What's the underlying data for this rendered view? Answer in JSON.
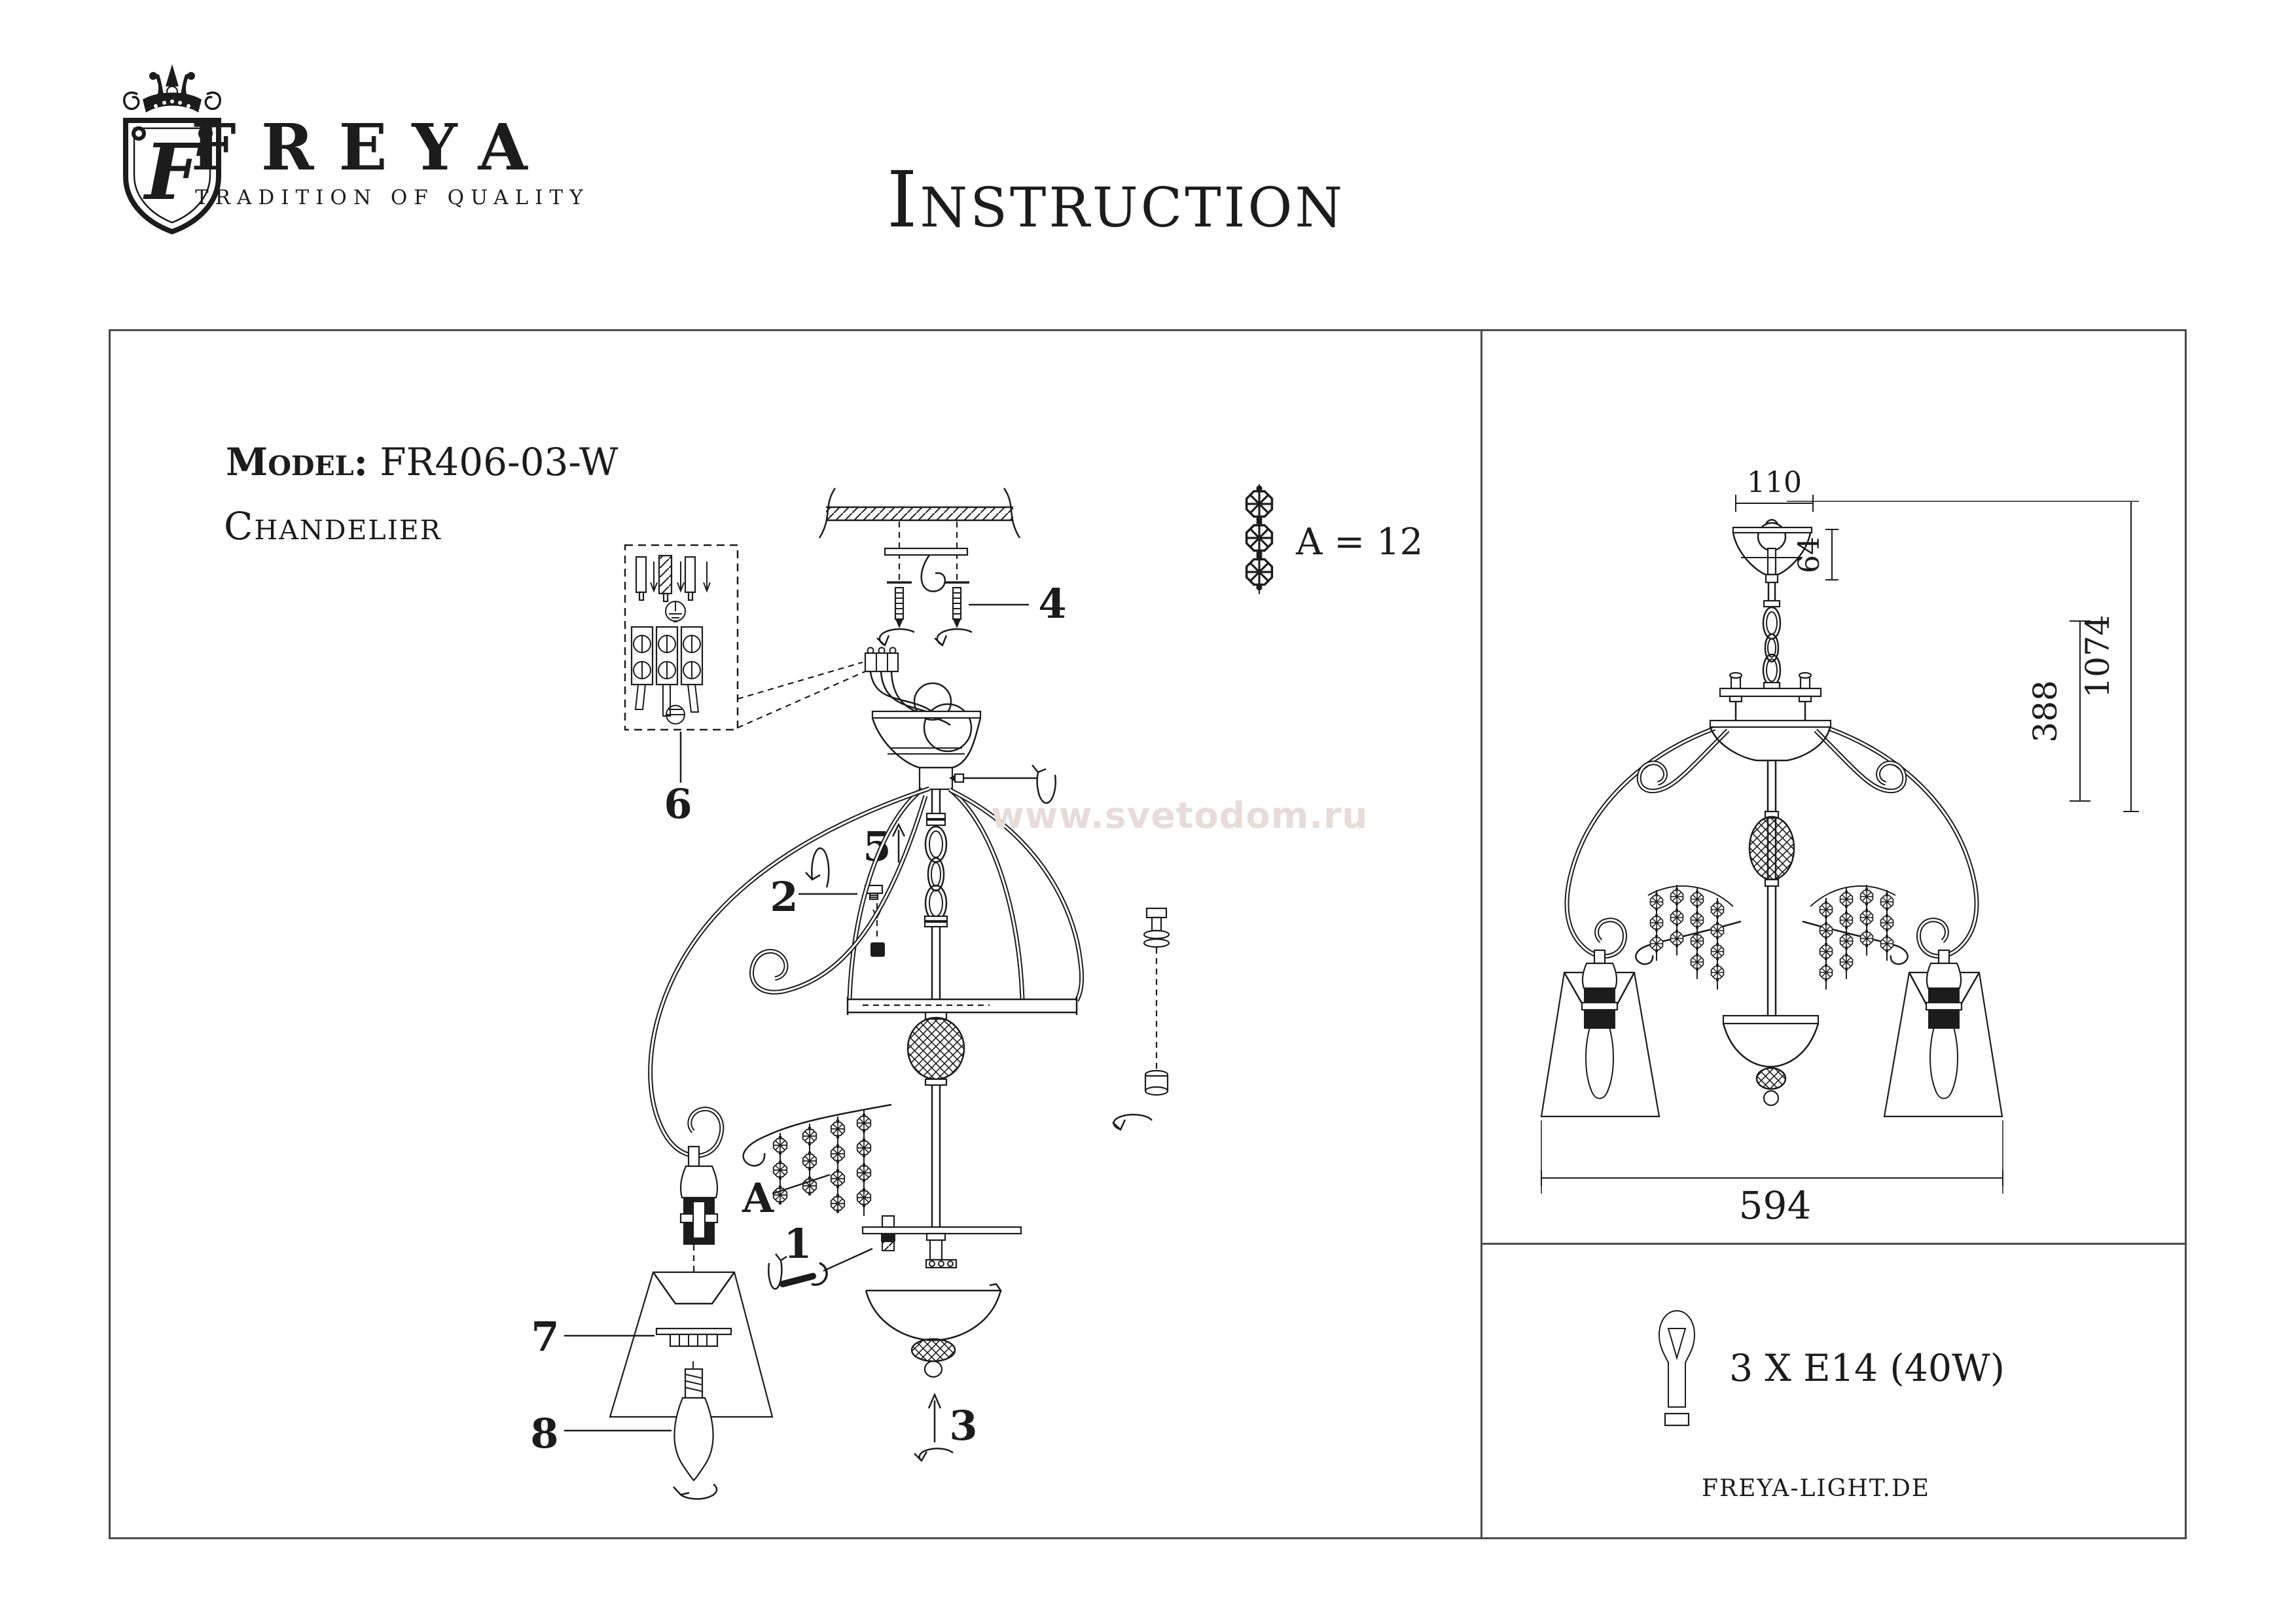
{
  "header": {
    "brand": "FREYA",
    "tagline": "TRADITION OF QUALITY",
    "title": "Instruction",
    "logo_letter": "F"
  },
  "product": {
    "model_label": "Model:",
    "model_value": "FR406-03-W",
    "type": "Chandelier"
  },
  "watermark": {
    "text": "www.svetodom.ru",
    "color": "#e8dcd9"
  },
  "legend": {
    "crystal_count": "A = 12"
  },
  "parts": {
    "p1": "1",
    "p2": "2",
    "p3": "3",
    "p4": "4",
    "p5": "5",
    "p6": "6",
    "p7": "7",
    "p8": "8",
    "pA": "A"
  },
  "dimensions": {
    "canopy_width": "110",
    "canopy_height": "64",
    "total_height": "1074",
    "body_height": "388",
    "diameter": "594"
  },
  "specs": {
    "lamps": "3 X E14 (40W)",
    "website": "FREYA-LIGHT.DE"
  },
  "colors": {
    "line": "#1c1c1c",
    "border": "#4a4a4a",
    "watermark": "#e8dcd9"
  }
}
